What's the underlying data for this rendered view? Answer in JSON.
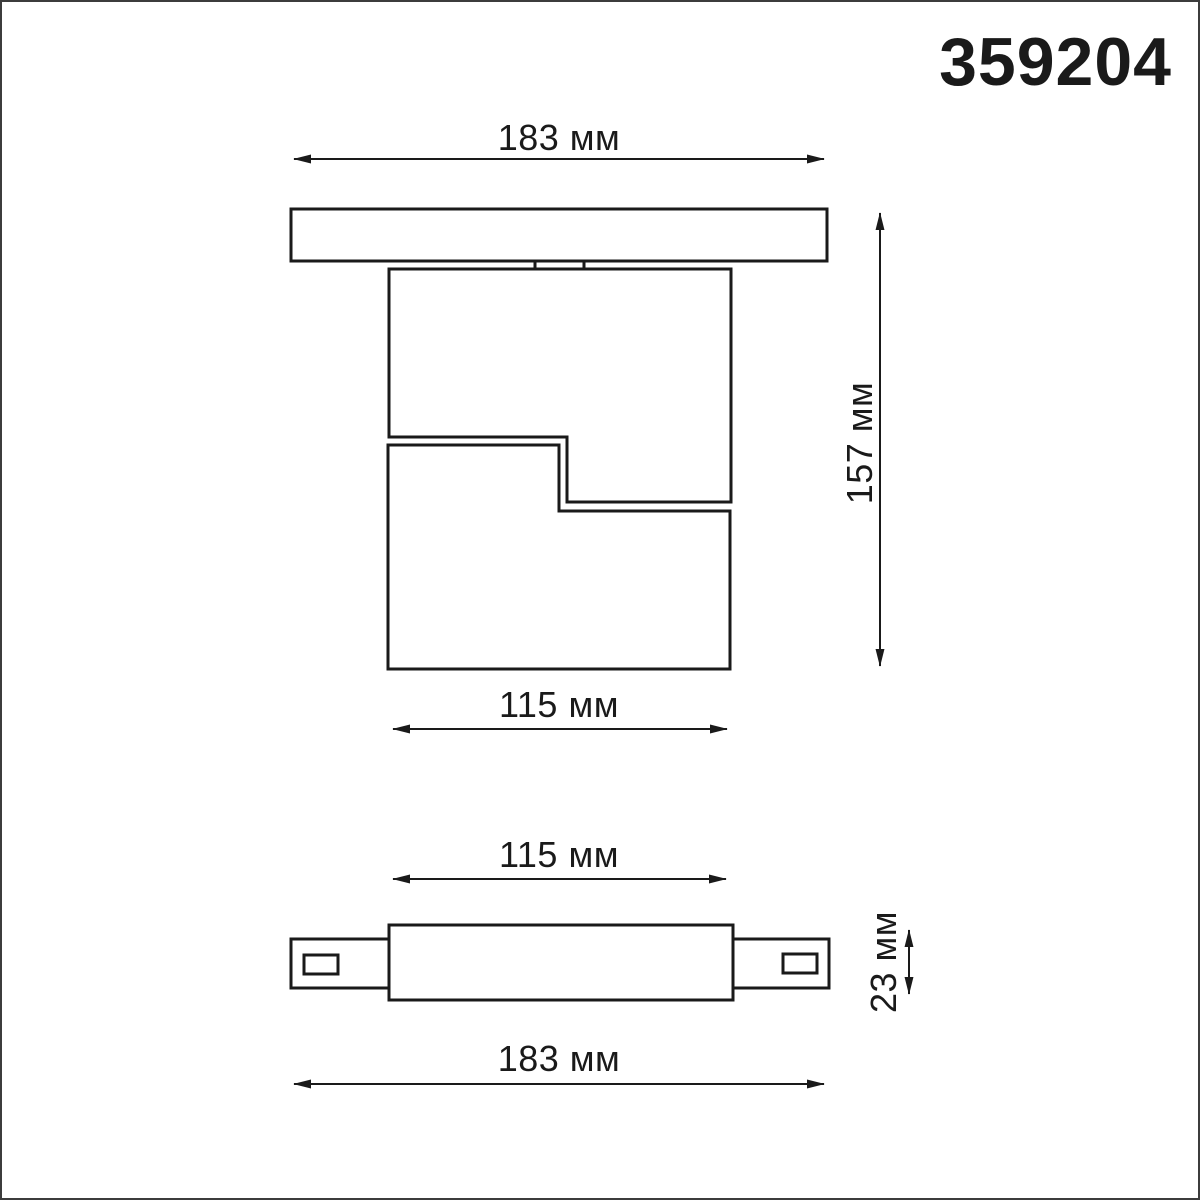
{
  "product_code": "359204",
  "unit": "мм",
  "colors": {
    "line": "#1a1a1a",
    "text": "#1a1a1a",
    "background": "#ffffff",
    "frame": "#3c3c3c"
  },
  "front_view": {
    "name": "fixture-on-track-front-view",
    "track_width_label": "183 мм",
    "overall_height_label": "157 мм",
    "body_width_label": "115 мм"
  },
  "track_view": {
    "name": "track-connector-top-view",
    "body_width_label": "115 мм",
    "track_height_label": "23 мм",
    "track_length_label": "183 мм"
  }
}
